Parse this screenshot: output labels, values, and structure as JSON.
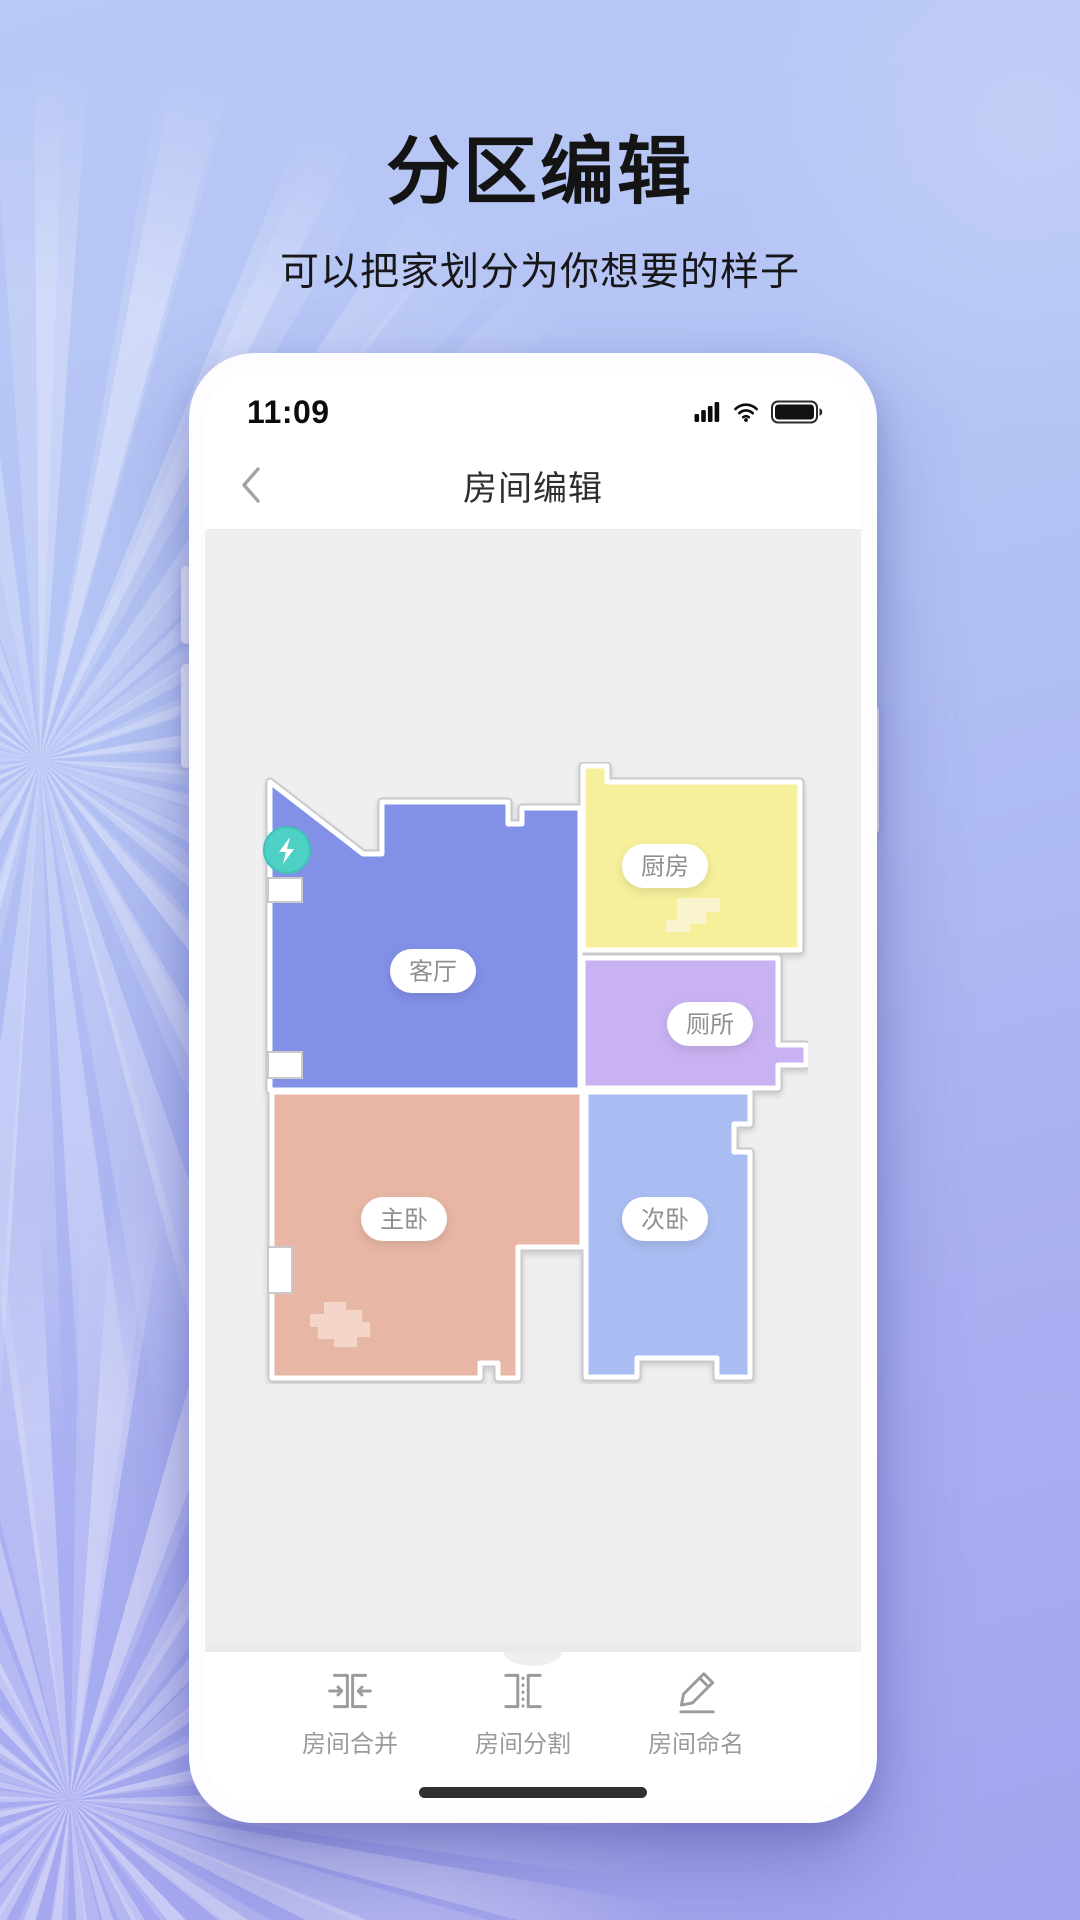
{
  "hero": {
    "title": "分区编辑",
    "subtitle": "可以把家划分为你想要的样子"
  },
  "phone": {
    "status_bar": {
      "time": "11:09"
    },
    "nav": {
      "title": "房间编辑"
    },
    "map": {
      "viewBox": "0 0 546 622",
      "colors": {
        "background": "#EFEFF1",
        "wall": "#FFFFFF",
        "outline": "#C9C9CC"
      },
      "rooms": [
        {
          "id": "living",
          "label": "客厅",
          "color": "#8290E8",
          "points": "8,20 101,92 120,92 120,40 246,40 246,62 260,62 260,46 318,46 318,328 8,328",
          "label_pos": [
            171,
            209
          ]
        },
        {
          "id": "kitchen",
          "label": "厨房",
          "color": "#F6F09C",
          "points": "321,4 345,4 345,20 538,20 538,188 321,188",
          "label_pos": [
            403,
            104
          ]
        },
        {
          "id": "toilet",
          "label": "厕所",
          "color": "#C9B2F2",
          "points": "321,196 516,196 516,283 544,283 544,303 516,303 516,326 321,326",
          "label_pos": [
            448,
            262
          ]
        },
        {
          "id": "master",
          "label": "主卧",
          "color": "#E8B6A4",
          "points": "10,330 320,330 320,485 256,485 256,616 236,616 236,601 218,601 218,616 10,616",
          "label_pos": [
            142,
            457
          ]
        },
        {
          "id": "second",
          "label": "次卧",
          "color": "#AABDF2",
          "points": "324,330 488,330 488,362 472,362 472,390 488,390 488,615 455,615 455,596 375,596 375,615 324,615",
          "label_pos": [
            403,
            457
          ]
        }
      ],
      "wall_stubs": [
        {
          "x": 6,
          "y": 116,
          "w": 34,
          "h": 24
        },
        {
          "x": 6,
          "y": 290,
          "w": 34,
          "h": 26
        },
        {
          "x": 6,
          "y": 485,
          "w": 24,
          "h": 46
        }
      ],
      "objects": [
        {
          "id": "kitchen-stairs",
          "color": "#FAF4CE",
          "points": "415,136 458,136 458,150 444,150 444,162 428,162 428,170 404,170 404,158 415,158"
        },
        {
          "id": "bedroom-furniture",
          "color": "#F3D5CA",
          "points": "62,540 84,540 84,548 100,548 100,560 108,560 108,575 95,575 95,585 72,585 72,577 56,577 56,565 48,565 48,552 62,552"
        }
      ],
      "dock": {
        "x": 25,
        "y": 88,
        "r": 23,
        "color": "#4ED0C5",
        "ring": "#3EC2B7"
      },
      "label_style": {
        "fill": "#FFFFFF",
        "text": "#8F8F8F",
        "w": 86,
        "h": 44
      }
    },
    "toolbar": {
      "items": [
        {
          "id": "merge",
          "label": "房间合并"
        },
        {
          "id": "split",
          "label": "房间分割"
        },
        {
          "id": "rename",
          "label": "房间命名"
        }
      ]
    }
  }
}
